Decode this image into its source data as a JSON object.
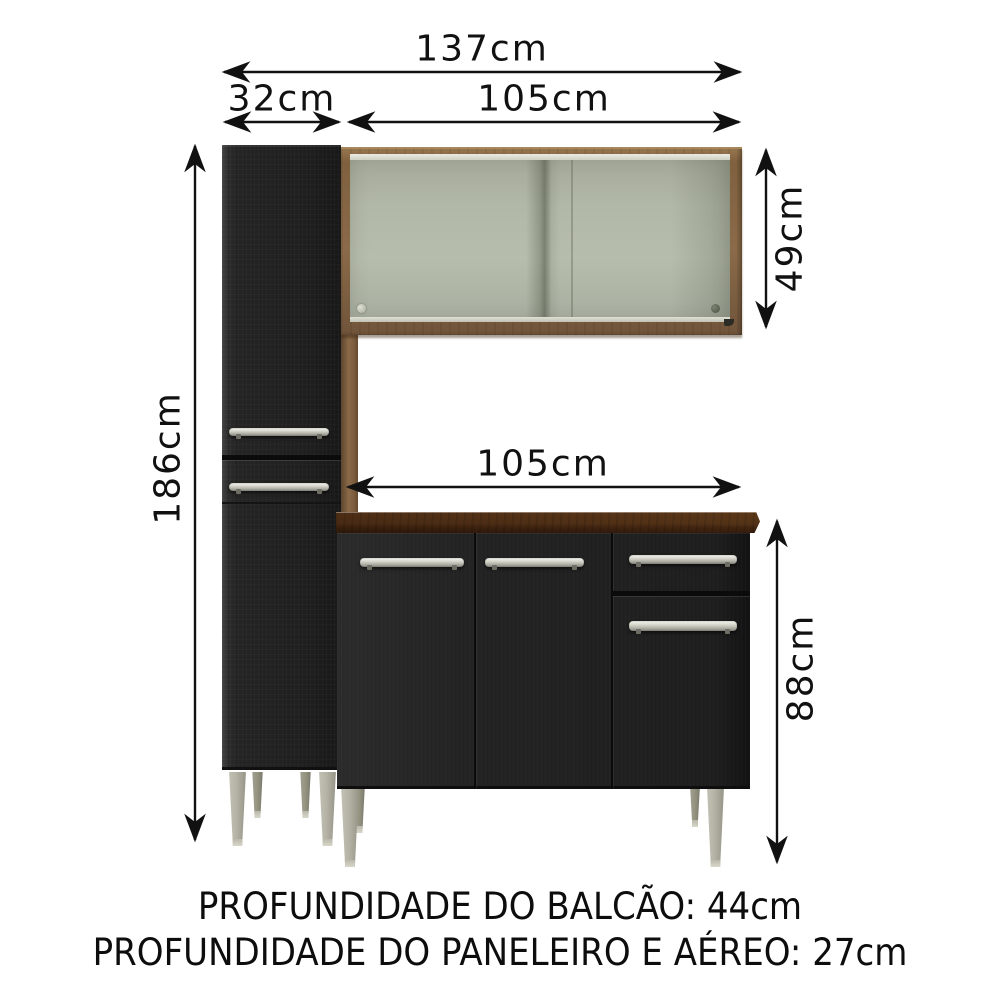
{
  "dimensions": {
    "total_width": "137cm",
    "tower_width": "32cm",
    "upper_cabinet_width": "105cm",
    "upper_cabinet_height": "49cm",
    "tower_height": "186cm",
    "counter_width": "105cm",
    "counter_height": "88cm"
  },
  "notes": {
    "line1": "PROFUNDIDADE DO BALCÃO: 44cm",
    "line2": "PROFUNDIDADE DO PANELEIRO E AÉREO: 27cm"
  },
  "icons": {
    "horizontal_dimension_arrow": "↔",
    "vertical_dimension_arrow": "↕"
  },
  "colors": {
    "background": "#ffffff",
    "dimension_line": "#111111",
    "cabinet_black": "#232323",
    "wood": "#8a6a48",
    "wood_dark": "#6e4f36",
    "glass": "#b2b8a7",
    "handle_silver": "#d9d9cf",
    "leg_gray": "#b4b3a5"
  }
}
